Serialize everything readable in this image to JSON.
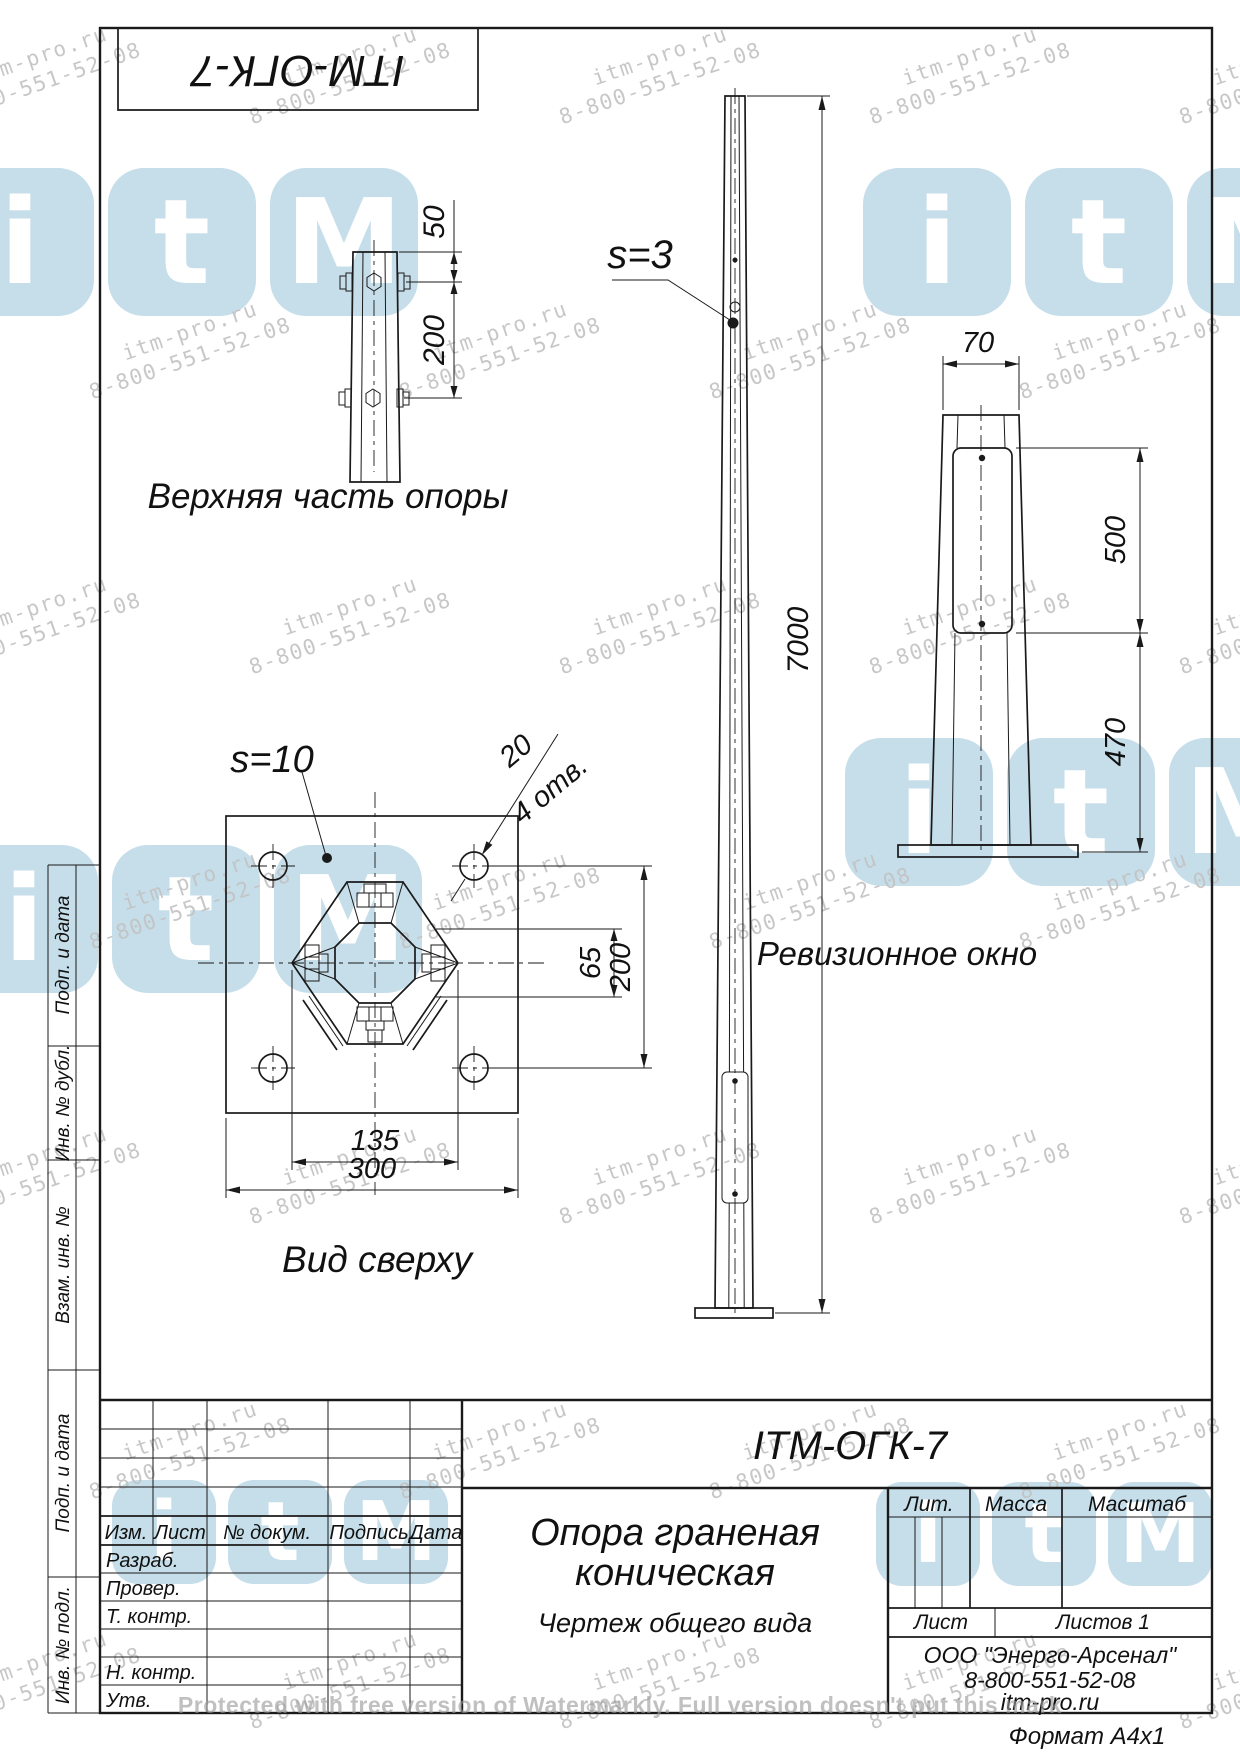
{
  "stamp": {
    "code_rotated": "ITM-ОГК-7"
  },
  "drawing": {
    "top_part": {
      "caption": "Верхняя часть опоры",
      "dim_50": "50",
      "dim_200": "200"
    },
    "pole": {
      "thickness": "s=3",
      "dim_height": "7000"
    },
    "window_view": {
      "caption": "Ревизионное окно",
      "dim_width": "70",
      "dim_500": "500",
      "dim_470": "470"
    },
    "top_view": {
      "caption": "Вид сверху",
      "thickness": "s=10",
      "holes_dia": "20",
      "holes_count": "4 отв.",
      "dim_65": "65",
      "dim_200": "200",
      "dim_135": "135",
      "dim_300": "300"
    }
  },
  "side_strip": {
    "labels": [
      "Подп. и дата",
      "Инв. № дубл.",
      "Взам. инв. №",
      "Подп. и дата",
      "Инв. № подл."
    ]
  },
  "title_block": {
    "code": "ITM-ОГК-7",
    "name_line1": "Опора граненая",
    "name_line2": "коническая",
    "doc_type": "Чертеж общего вида",
    "headers": {
      "izm": "Изм.",
      "list": "Лист",
      "dokum": "№ докум.",
      "podpis": "Подпись",
      "data": "Дата",
      "lit": "Лит.",
      "massa": "Масса",
      "masshtab": "Масштаб",
      "list2": "Лист",
      "listov": "Листов 1"
    },
    "rows": [
      "Разраб.",
      "Провер.",
      "Т. контр.",
      "Н. контр.",
      "Утв."
    ],
    "company": {
      "name": "ООО \"Энерго-Арсенал\"",
      "phone": "8-800-551-52-08",
      "site": "itm-pro.ru"
    },
    "format": "Формат  А4х1"
  },
  "watermarks": {
    "line1": "itm-pro.ru",
    "line2": "8-800-551-52-08",
    "logo_letters": [
      "i",
      "t",
      "M"
    ],
    "logo_color": "#c6deea",
    "text_color": "#c2c2c2",
    "protected_note": "Protected with free version of Watermarkly. Full version doesn't put this mark"
  }
}
